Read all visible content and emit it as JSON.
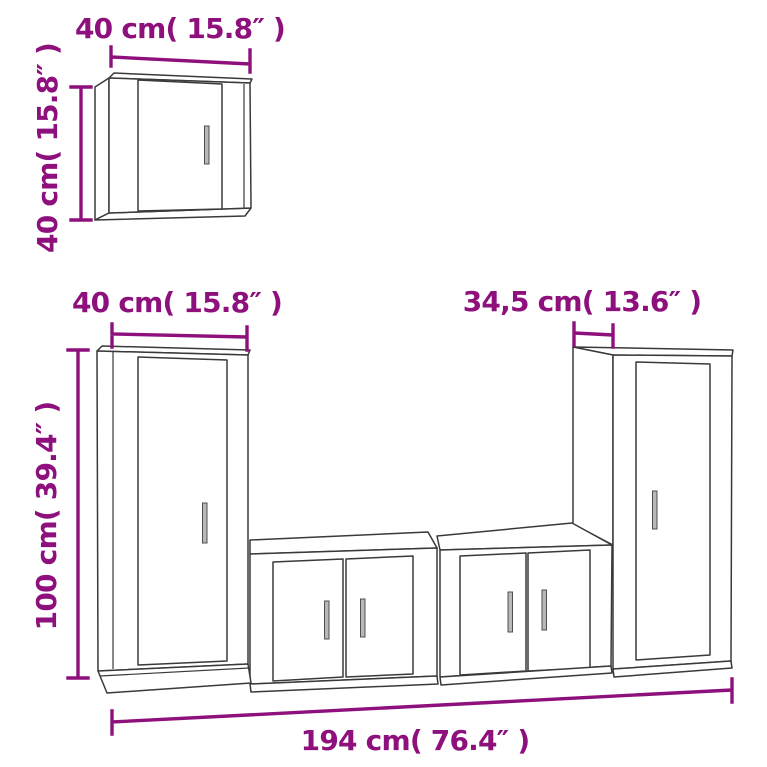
{
  "colors": {
    "dimension_accent": "#8E107D",
    "outline": "#3A3A3A",
    "handle_fill": "#B8B8B8",
    "background": "#FFFFFF"
  },
  "dimensions": {
    "wall_cabinet": {
      "width_label": "40 cm( 15.8″ )",
      "height_label": "40 cm( 15.8″ )"
    },
    "left_tall_cabinet": {
      "width_label": "40 cm( 15.8″ )",
      "height_label": "100 cm( 39.4″ )"
    },
    "right_tall_cabinet": {
      "depth_label": "34,5 cm( 13.6″ )"
    },
    "total": {
      "width_label": "194 cm( 76.4″ )"
    }
  }
}
